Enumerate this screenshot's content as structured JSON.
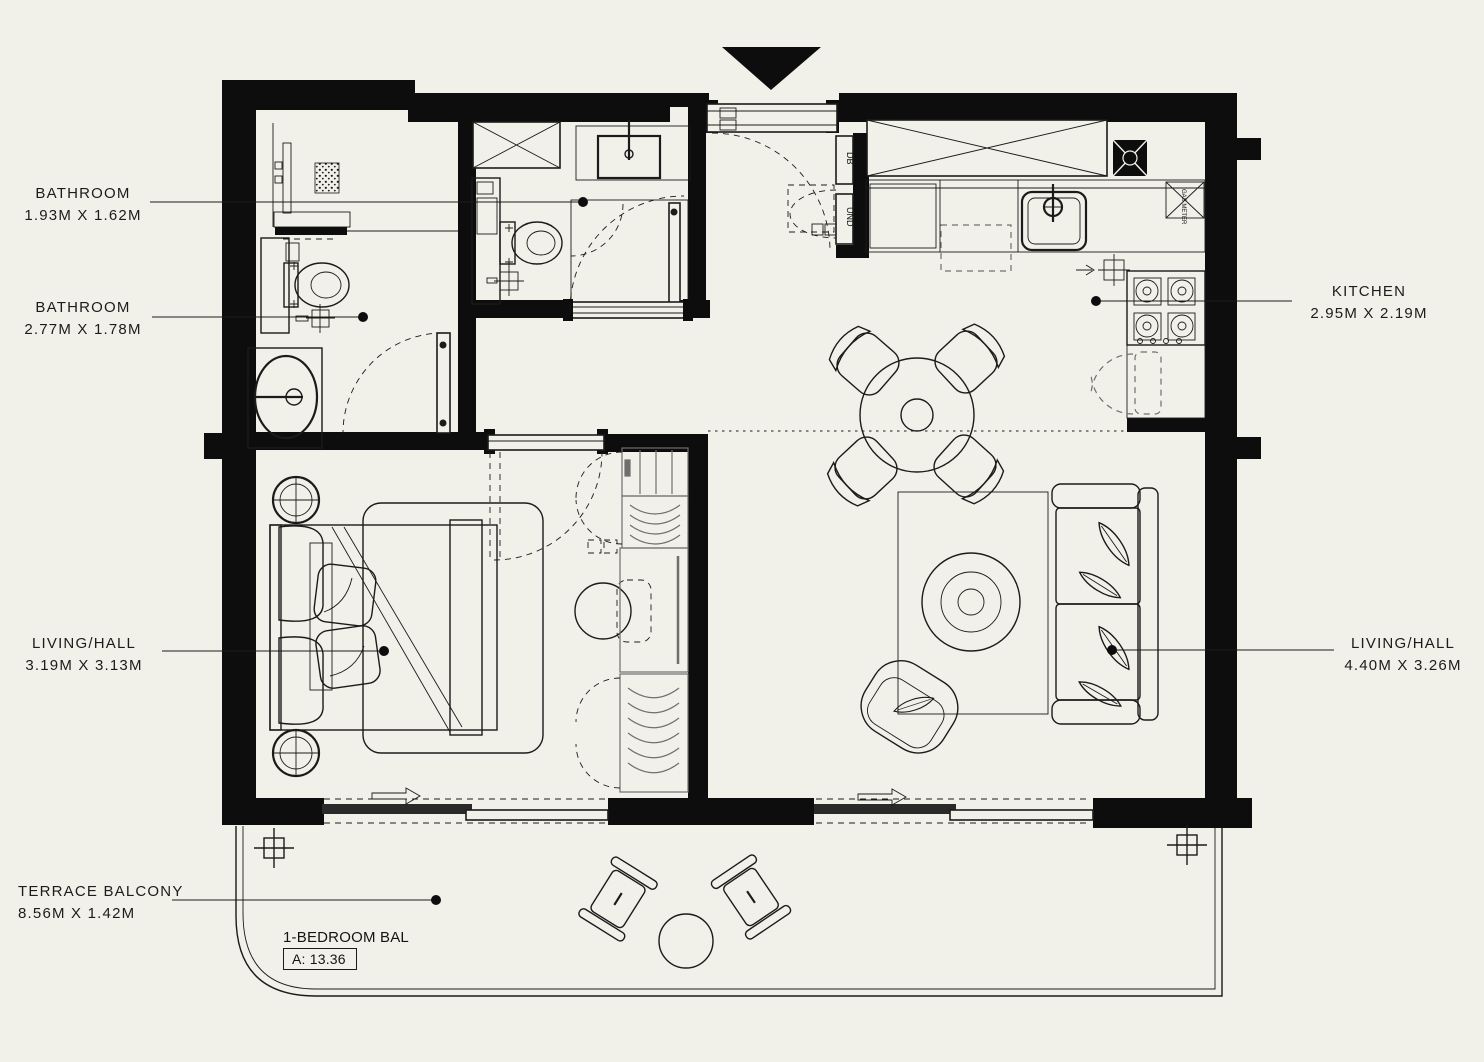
{
  "colors": {
    "background": "#f1f0e9",
    "ink": "#141414"
  },
  "labels": {
    "bathroom_top": {
      "name": "BATHROOM",
      "dims": "1.93M X 1.62M"
    },
    "bathroom_left": {
      "name": "BATHROOM",
      "dims": "2.77M X 1.78M"
    },
    "kitchen": {
      "name": "KITCHEN",
      "dims": "2.95M X 2.19M"
    },
    "bedroom": {
      "name": "LIVING/HALL",
      "dims": "3.19M X 3.13M"
    },
    "living": {
      "name": "LIVING/HALL",
      "dims": "4.40M X 3.26M"
    },
    "terrace": {
      "name": "TERRACE BALCONY",
      "dims": "8.56M X 1.42M"
    }
  },
  "plan_tags": {
    "balcony_name": "1-BEDROOM BAL",
    "balcony_area": "A: 13.36",
    "db_panel": "DB",
    "und_panel": "UND",
    "gas_meter": "GAS METER"
  }
}
